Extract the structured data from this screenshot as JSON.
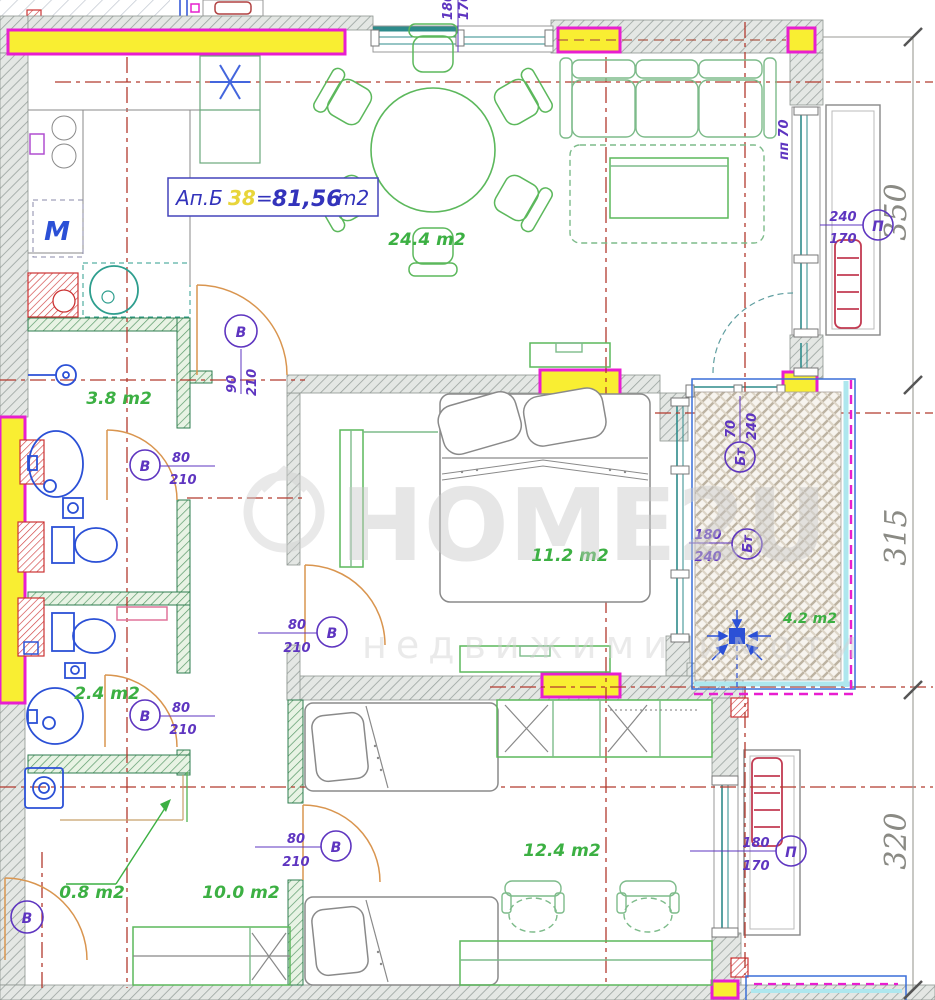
{
  "title": {
    "label": "Ап.Б",
    "number": "38",
    "equals": "=",
    "area_value": "81,56",
    "area_unit": "m2"
  },
  "rooms": {
    "living_dining": "24.4 m2",
    "bathroom": "3.8 m2",
    "bedroom": "11.2 m2",
    "wc": "2.4 m2",
    "balcony": "4.2 m2",
    "kids_room": "12.4 m2",
    "hallway": "10.0 m2",
    "storage": "0.8 m2"
  },
  "door_labels": {
    "letter": "В",
    "corridor_w": "90",
    "corridor_h": "210",
    "bathroom_w": "80",
    "bathroom_h": "210",
    "wc_w": "80",
    "wc_h": "210",
    "bedroom_w": "80",
    "bedroom_h": "210",
    "kids_w": "80",
    "kids_h": "210"
  },
  "window_labels": {
    "letter": "П",
    "balcony_letter": "Бт",
    "right_w": "240",
    "right_h": "170",
    "bottom_w": "180",
    "bottom_h": "170",
    "top_w": "180",
    "top_h": "170",
    "balcony_door_w": "70",
    "balcony_door_h": "240",
    "balcony_window_w": "180",
    "balcony_window_h": "240",
    "parapet": "пп 70"
  },
  "dimensions": {
    "top": "350",
    "middle": "315",
    "bottom": "320"
  },
  "appliances": {
    "washing_machine": "М"
  },
  "watermark": {
    "brand": "HOME2U",
    "subtitle": "недвижими имоти"
  },
  "colors": {
    "highlight_yellow": "#f9ee32",
    "highlight_magenta": "#e81ed0",
    "axis_red": "#b23a2e",
    "partition_green": "#2e7d4f",
    "furniture_green": "#5cb85c",
    "fixture_blue": "#2b50d6",
    "door_orange": "#d9954f",
    "label_purple": "#5e35c0",
    "area_green": "#3cb043",
    "title_blue": "#3333bb",
    "window_teal": "#2e8b8b"
  }
}
